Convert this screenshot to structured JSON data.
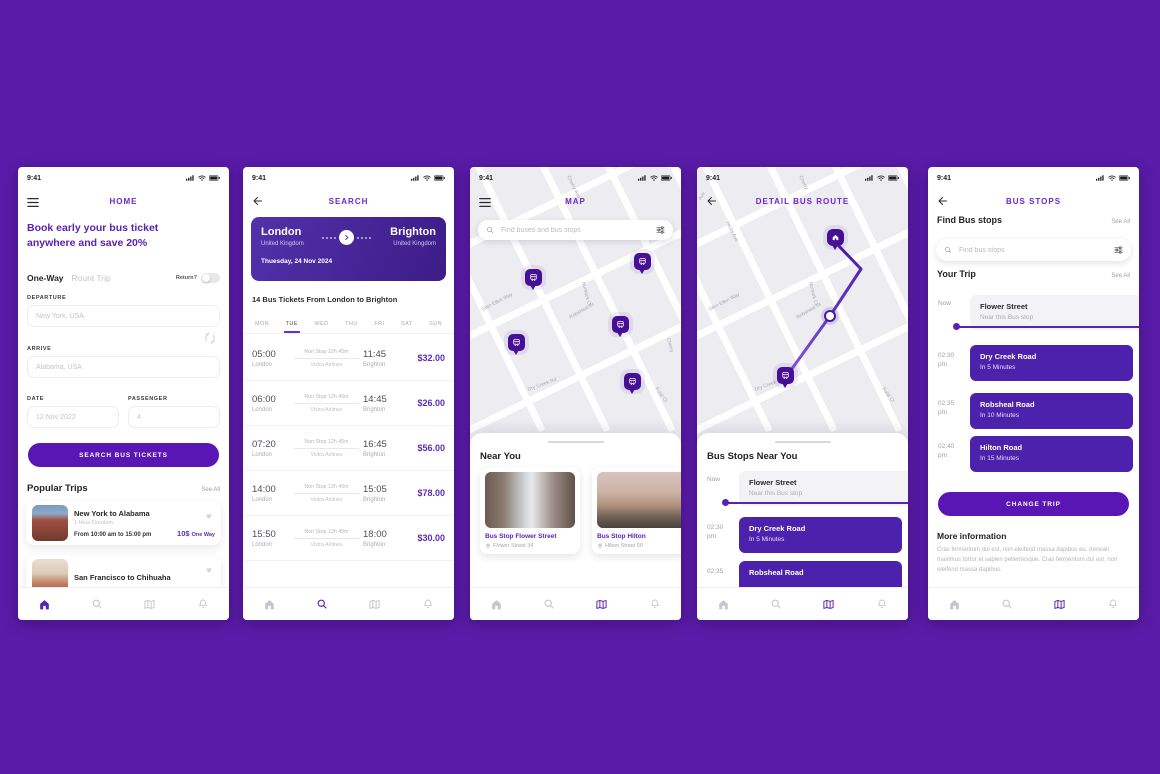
{
  "colors": {
    "background": "#5A1BA8",
    "primary": "#5B21B6",
    "title": "#6D28C9",
    "price": "#5B2DB3",
    "button": "#5A15B5",
    "pin": "#470F96",
    "stop_card": "#4C22AC"
  },
  "status": {
    "time": "9:41"
  },
  "home": {
    "title": "HOME",
    "headline": "Book early your bus ticket anywhere and save 20%",
    "one_way": "One-Way",
    "round_trip": "Rount Trip",
    "return_label": "Return?",
    "departure_label": "DEPARTURE",
    "departure_placeholder": "New York, USA",
    "arrive_label": "ARRIVE",
    "arrive_placeholder": "Alabama, USA",
    "date_label": "DATE",
    "date_value": "12 Nov 2022",
    "passenger_label": "PASSENGER",
    "passenger_value": "4",
    "search_button": "SEARCH BUS TICKETS",
    "popular_heading": "Popular Trips",
    "see_all": "See All",
    "trips": [
      {
        "title": "New York to Alabama",
        "duration": "1 Hour Duration:",
        "time_range": "From 10:00 am to 15:00 pm",
        "price": "10$",
        "price_note": "One Way"
      },
      {
        "title": "San Francisco to Chihuaha"
      }
    ]
  },
  "search": {
    "title": "SEARCH",
    "from_city": "London",
    "from_country": "United Kingdom",
    "to_city": "Brighton",
    "to_country": "United Kingdom",
    "date": "Thuesday, 24 Nov 2024",
    "results_heading": "14 Bus Tickets From London to Brighton",
    "days": [
      "MON",
      "TUE",
      "WED",
      "THU",
      "FRI",
      "SAT",
      "SUN"
    ],
    "active_day": "TUE",
    "tickets": [
      {
        "dep_time": "05:00",
        "from": "London",
        "stops": "Non Stop 12h 45m",
        "carrier": "Vistra Airlines",
        "arr_time": "11:45",
        "to": "Brighton",
        "price": "$32.00"
      },
      {
        "dep_time": "06:00",
        "from": "London",
        "stops": "Non Stop 12h 45m",
        "carrier": "Vistra Airlines",
        "arr_time": "14:45",
        "to": "Brighton",
        "price": "$26.00"
      },
      {
        "dep_time": "07:20",
        "from": "London",
        "stops": "Non Stop 12h 45m",
        "carrier": "Vistra Airlines",
        "arr_time": "16:45",
        "to": "Brighton",
        "price": "$56.00"
      },
      {
        "dep_time": "14:00",
        "from": "London",
        "stops": "Non Stop 12h 45m",
        "carrier": "Vistra Airlines",
        "arr_time": "15:05",
        "to": "Brighton",
        "price": "$78.00"
      },
      {
        "dep_time": "15:50",
        "from": "London",
        "stops": "Non Stop 12h 45m",
        "carrier": "Vistra Airlines",
        "arr_time": "18:00",
        "to": "Brighton",
        "price": "$30.00"
      }
    ]
  },
  "map": {
    "title": "MAP",
    "search_placeholder": "Find buses and bus stops",
    "streets": [
      "Cherry Ave",
      "s Ave",
      "Glen Ellen Way",
      "Nomack Ct",
      "Robsheal Dr",
      "Dry Creek Rd",
      "Fulal Ct",
      "Cherry"
    ],
    "near_heading": "Near You",
    "stops": [
      {
        "title": "Bus Stop Flower Street",
        "address": "Flower Street 34"
      },
      {
        "title": "Bus Stop Hilton",
        "address": "Hilton Street 50"
      }
    ]
  },
  "route": {
    "title": "DETAIL BUS ROUTE",
    "streets": [
      "Ave",
      "Hicks Ave",
      "Cherry",
      "Nomark Ct",
      "Glen Ellen Way",
      "Robsheal Dr",
      "Dry Creek Rd",
      "Fulal Ct"
    ],
    "sheet_heading": "Bus Stops Near You",
    "stops": [
      {
        "time": "Now",
        "ampm": "",
        "name": "Flower Street",
        "detail": "Near this Bus stop"
      },
      {
        "time": "02:30",
        "ampm": "pm",
        "name": "Dry Creek Road",
        "detail": "In 5 Minutes"
      },
      {
        "time": "02:35",
        "ampm": "",
        "name": "Robsheal Road",
        "detail": ""
      }
    ]
  },
  "bus_stops": {
    "title": "BUS STOPS",
    "find_heading": "Find Bus stops",
    "see_all": "See All",
    "search_placeholder": "Find bus stops",
    "trip_heading": "Your Trip",
    "stops": [
      {
        "time": "Now",
        "ampm": "",
        "name": "Flower Street",
        "detail": "Near this Bus stop"
      },
      {
        "time": "02:30",
        "ampm": "pm",
        "name": "Dry Creek Road",
        "detail": "In 5 Minutes"
      },
      {
        "time": "02:35",
        "ampm": "pm",
        "name": "Robsheal Road",
        "detail": "In 10 Minutes"
      },
      {
        "time": "02:40",
        "ampm": "pm",
        "name": "Hilton Road",
        "detail": "In 15 Minutes"
      }
    ],
    "change_button": "CHANGE TRIP",
    "more_heading": "More information",
    "more_text": "Cras fermentum dui est, non eleifend massa dapibus eu. Aenean maximus tortor et sapien pellentesque. Cras fermentum dui est, non eleifend massa dapibus."
  }
}
